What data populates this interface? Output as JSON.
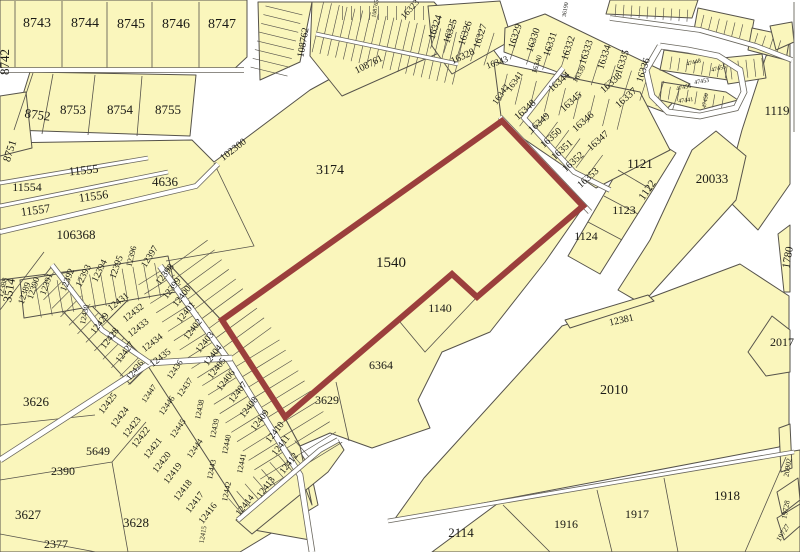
{
  "map": {
    "type": "cadastral-parcel-map",
    "highlighted_parcel": "1540",
    "colors": {
      "background": "#FFFFFF",
      "parcel_fill": "#FAF6BC",
      "parcel_border": "#56534B",
      "highlight_outline": "#9B3F3C",
      "road_casing": "#6A675E",
      "label": "#1A1A16"
    },
    "labels": [
      {
        "t": "8742",
        "x": 9,
        "y": 62,
        "r": -90,
        "s": 13
      },
      {
        "t": "8743",
        "x": 37,
        "y": 27,
        "r": 0,
        "s": 14
      },
      {
        "t": "8744",
        "x": 85,
        "y": 27,
        "r": 0,
        "s": 14
      },
      {
        "t": "8745",
        "x": 131,
        "y": 28,
        "r": 0,
        "s": 14
      },
      {
        "t": "8746",
        "x": 176,
        "y": 28,
        "r": 0,
        "s": 14
      },
      {
        "t": "8747",
        "x": 222,
        "y": 28,
        "r": 0,
        "s": 14
      },
      {
        "t": "8751",
        "x": 13,
        "y": 152,
        "r": -72,
        "s": 11
      },
      {
        "t": "8752",
        "x": 37,
        "y": 119,
        "r": 8,
        "s": 13
      },
      {
        "t": "8753",
        "x": 73,
        "y": 114,
        "r": 0,
        "s": 13
      },
      {
        "t": "8754",
        "x": 120,
        "y": 114,
        "r": 0,
        "s": 13
      },
      {
        "t": "8755",
        "x": 168,
        "y": 114,
        "r": 0,
        "s": 13
      },
      {
        "t": "11554",
        "x": 27,
        "y": 191,
        "r": 0,
        "s": 12
      },
      {
        "t": "11555",
        "x": 84,
        "y": 174,
        "r": -6,
        "s": 12
      },
      {
        "t": "11556",
        "x": 94,
        "y": 200,
        "r": -8,
        "s": 12
      },
      {
        "t": "11557",
        "x": 36,
        "y": 214,
        "r": -8,
        "s": 12
      },
      {
        "t": "4636",
        "x": 165,
        "y": 186,
        "r": 0,
        "s": 13
      },
      {
        "t": "106368",
        "x": 76,
        "y": 239,
        "r": 0,
        "s": 13
      },
      {
        "t": "3174",
        "x": 330,
        "y": 174,
        "r": 0,
        "s": 14
      },
      {
        "t": "1540",
        "x": 391,
        "y": 267,
        "r": 0,
        "s": 15
      },
      {
        "t": "1140",
        "x": 440,
        "y": 312,
        "r": 0,
        "s": 12
      },
      {
        "t": "6364",
        "x": 381,
        "y": 369,
        "r": 0,
        "s": 12
      },
      {
        "t": "3629",
        "x": 327,
        "y": 404,
        "r": 0,
        "s": 12
      },
      {
        "t": "102300",
        "x": 235,
        "y": 152,
        "r": -38,
        "s": 10
      },
      {
        "t": "108761",
        "x": 370,
        "y": 67,
        "r": -27,
        "s": 10
      },
      {
        "t": "108762",
        "x": 306,
        "y": 43,
        "r": -80,
        "s": 10
      },
      {
        "t": "108765",
        "x": 377,
        "y": 9,
        "r": -80,
        "s": 6
      },
      {
        "t": "36190",
        "x": 567,
        "y": 10,
        "r": -80,
        "s": 6
      },
      {
        "t": "3514",
        "x": 13,
        "y": 291,
        "r": -80,
        "s": 12
      },
      {
        "t": "3626",
        "x": 36,
        "y": 406,
        "r": 0,
        "s": 13
      },
      {
        "t": "2390",
        "x": 63,
        "y": 475,
        "r": 0,
        "s": 12
      },
      {
        "t": "5649",
        "x": 98,
        "y": 455,
        "r": 0,
        "s": 12
      },
      {
        "t": "3627",
        "x": 28,
        "y": 519,
        "r": 0,
        "s": 13
      },
      {
        "t": "3628",
        "x": 136,
        "y": 527,
        "r": 0,
        "s": 13
      },
      {
        "t": "2377",
        "x": 56,
        "y": 548,
        "r": 0,
        "s": 12
      },
      {
        "t": "12388",
        "x": 5,
        "y": 288,
        "r": -75,
        "s": 8
      },
      {
        "t": "12389",
        "x": 27,
        "y": 294,
        "r": -72,
        "s": 9
      },
      {
        "t": "12390",
        "x": 36,
        "y": 289,
        "r": -72,
        "s": 9
      },
      {
        "t": "12391",
        "x": 49,
        "y": 285,
        "r": -70,
        "s": 9
      },
      {
        "t": "12392",
        "x": 70,
        "y": 281,
        "r": -68,
        "s": 9.5
      },
      {
        "t": "12393",
        "x": 86,
        "y": 277,
        "r": -64,
        "s": 9.5
      },
      {
        "t": "12394",
        "x": 102,
        "y": 272,
        "r": -64,
        "s": 9.5
      },
      {
        "t": "12395",
        "x": 119,
        "y": 268,
        "r": -70,
        "s": 9.5
      },
      {
        "t": "12396",
        "x": 134,
        "y": 257,
        "r": -76,
        "s": 8.5
      },
      {
        "t": "12397",
        "x": 152,
        "y": 258,
        "r": -58,
        "s": 9.5
      },
      {
        "t": "12398",
        "x": 167,
        "y": 276,
        "r": -52,
        "s": 9.5
      },
      {
        "t": "12399",
        "x": 174,
        "y": 290,
        "r": -52,
        "s": 9.5
      },
      {
        "t": "12400",
        "x": 184,
        "y": 298,
        "r": -52,
        "s": 9.5
      },
      {
        "t": "12401",
        "x": 188,
        "y": 314,
        "r": -52,
        "s": 9.5
      },
      {
        "t": "12402",
        "x": 195,
        "y": 331,
        "r": -52,
        "s": 9.5
      },
      {
        "t": "12403",
        "x": 207,
        "y": 344,
        "r": -52,
        "s": 9.5
      },
      {
        "t": "12404",
        "x": 215,
        "y": 357,
        "r": -52,
        "s": 9.5
      },
      {
        "t": "12405",
        "x": 219,
        "y": 370,
        "r": -52,
        "s": 9.5
      },
      {
        "t": "12406",
        "x": 228,
        "y": 382,
        "r": -52,
        "s": 9.5
      },
      {
        "t": "12407",
        "x": 240,
        "y": 394,
        "r": -52,
        "s": 9.5
      },
      {
        "t": "12408",
        "x": 251,
        "y": 409,
        "r": -52,
        "s": 9.5
      },
      {
        "t": "12409",
        "x": 262,
        "y": 422,
        "r": -52,
        "s": 9.5
      },
      {
        "t": "12410",
        "x": 277,
        "y": 434,
        "r": -52,
        "s": 9.5
      },
      {
        "t": "12411",
        "x": 283,
        "y": 447,
        "r": -52,
        "s": 9.5
      },
      {
        "t": "12412",
        "x": 291,
        "y": 465,
        "r": -52,
        "s": 9.5
      },
      {
        "t": "12413",
        "x": 268,
        "y": 489,
        "r": -52,
        "s": 9.5
      },
      {
        "t": "12414",
        "x": 247,
        "y": 507,
        "r": -52,
        "s": 9.5
      },
      {
        "t": "12415",
        "x": 205,
        "y": 535,
        "r": -80,
        "s": 7
      },
      {
        "t": "12416",
        "x": 210,
        "y": 515,
        "r": -52,
        "s": 9.5
      },
      {
        "t": "12417",
        "x": 197,
        "y": 504,
        "r": -52,
        "s": 9.5
      },
      {
        "t": "12418",
        "x": 185,
        "y": 492,
        "r": -52,
        "s": 9.5
      },
      {
        "t": "12419",
        "x": 175,
        "y": 475,
        "r": -52,
        "s": 9.5
      },
      {
        "t": "12420",
        "x": 164,
        "y": 464,
        "r": -52,
        "s": 9.5
      },
      {
        "t": "12421",
        "x": 155,
        "y": 450,
        "r": -52,
        "s": 9.5
      },
      {
        "t": "12422",
        "x": 143,
        "y": 439,
        "r": -52,
        "s": 9.5
      },
      {
        "t": "12423",
        "x": 134,
        "y": 429,
        "r": -52,
        "s": 9.5
      },
      {
        "t": "12424",
        "x": 122,
        "y": 419,
        "r": -52,
        "s": 9.5
      },
      {
        "t": "12425",
        "x": 110,
        "y": 405,
        "r": -52,
        "s": 9.5
      },
      {
        "t": "12426",
        "x": 137,
        "y": 372,
        "r": -52,
        "s": 9
      },
      {
        "t": "12427",
        "x": 127,
        "y": 354,
        "r": -52,
        "s": 9.5
      },
      {
        "t": "12428",
        "x": 112,
        "y": 340,
        "r": -52,
        "s": 9.5
      },
      {
        "t": "12429",
        "x": 102,
        "y": 325,
        "r": -52,
        "s": 9.5
      },
      {
        "t": "12430",
        "x": 87,
        "y": 315,
        "r": -78,
        "s": 8
      },
      {
        "t": "12431",
        "x": 120,
        "y": 304,
        "r": -38,
        "s": 9.5
      },
      {
        "t": "12432",
        "x": 135,
        "y": 315,
        "r": -38,
        "s": 9.5
      },
      {
        "t": "12433",
        "x": 140,
        "y": 330,
        "r": -38,
        "s": 9.5
      },
      {
        "t": "12434",
        "x": 154,
        "y": 345,
        "r": -38,
        "s": 9.5
      },
      {
        "t": "12435",
        "x": 162,
        "y": 360,
        "r": -38,
        "s": 9.5
      },
      {
        "t": "12436",
        "x": 177,
        "y": 371,
        "r": -55,
        "s": 8.5
      },
      {
        "t": "12437",
        "x": 187,
        "y": 389,
        "r": -55,
        "s": 8.5
      },
      {
        "t": "12438",
        "x": 202,
        "y": 410,
        "r": -78,
        "s": 8
      },
      {
        "t": "12439",
        "x": 217,
        "y": 429,
        "r": -78,
        "s": 8
      },
      {
        "t": "12440",
        "x": 229,
        "y": 445,
        "r": -78,
        "s": 8
      },
      {
        "t": "12441",
        "x": 244,
        "y": 464,
        "r": -78,
        "s": 8
      },
      {
        "t": "12442",
        "x": 229,
        "y": 492,
        "r": -78,
        "s": 8
      },
      {
        "t": "12443",
        "x": 214,
        "y": 470,
        "r": -78,
        "s": 8
      },
      {
        "t": "12444",
        "x": 197,
        "y": 450,
        "r": -55,
        "s": 8.5
      },
      {
        "t": "12445",
        "x": 180,
        "y": 430,
        "r": -55,
        "s": 8.5
      },
      {
        "t": "12446",
        "x": 169,
        "y": 407,
        "r": -55,
        "s": 8.5
      },
      {
        "t": "12447",
        "x": 151,
        "y": 395,
        "r": -55,
        "s": 8
      },
      {
        "t": "16323",
        "x": 412,
        "y": 11,
        "r": -48,
        "s": 9
      },
      {
        "t": "16324",
        "x": 438,
        "y": 28,
        "r": -72,
        "s": 10
      },
      {
        "t": "16325",
        "x": 453,
        "y": 32,
        "r": -72,
        "s": 10
      },
      {
        "t": "16326",
        "x": 468,
        "y": 34,
        "r": -72,
        "s": 10
      },
      {
        "t": "16327",
        "x": 483,
        "y": 37,
        "r": -72,
        "s": 10
      },
      {
        "t": "16328",
        "x": 464,
        "y": 59,
        "r": -25,
        "s": 10
      },
      {
        "t": "16329",
        "x": 518,
        "y": 37,
        "r": -72,
        "s": 10
      },
      {
        "t": "16330",
        "x": 536,
        "y": 41,
        "r": -72,
        "s": 10
      },
      {
        "t": "16331",
        "x": 553,
        "y": 45,
        "r": -72,
        "s": 10
      },
      {
        "t": "16332",
        "x": 571,
        "y": 49,
        "r": -72,
        "s": 10
      },
      {
        "t": "16333",
        "x": 589,
        "y": 53,
        "r": -72,
        "s": 10
      },
      {
        "t": "16334",
        "x": 607,
        "y": 58,
        "r": -72,
        "s": 10
      },
      {
        "t": "16335",
        "x": 625,
        "y": 63,
        "r": -72,
        "s": 10
      },
      {
        "t": "16336",
        "x": 646,
        "y": 71,
        "r": -72,
        "s": 10
      },
      {
        "t": "16343",
        "x": 498,
        "y": 65,
        "r": -20,
        "s": 9
      },
      {
        "t": "16340",
        "x": 539,
        "y": 65,
        "r": -72,
        "s": 7.5
      },
      {
        "t": "16339",
        "x": 581,
        "y": 75,
        "r": -60,
        "s": 7.5
      },
      {
        "t": "16338",
        "x": 613,
        "y": 85,
        "r": -42,
        "s": 10
      },
      {
        "t": "16337",
        "x": 628,
        "y": 100,
        "r": -42,
        "s": 10
      },
      {
        "t": "16341",
        "x": 517,
        "y": 83,
        "r": -55,
        "s": 9
      },
      {
        "t": "16342",
        "x": 503,
        "y": 96,
        "r": -55,
        "s": 9
      },
      {
        "t": "16344",
        "x": 561,
        "y": 84,
        "r": -42,
        "s": 10
      },
      {
        "t": "16345",
        "x": 573,
        "y": 104,
        "r": -42,
        "s": 10
      },
      {
        "t": "16346",
        "x": 585,
        "y": 124,
        "r": -42,
        "s": 10
      },
      {
        "t": "16347",
        "x": 600,
        "y": 143,
        "r": -42,
        "s": 10
      },
      {
        "t": "16348",
        "x": 527,
        "y": 112,
        "r": -42,
        "s": 10
      },
      {
        "t": "16349",
        "x": 541,
        "y": 125,
        "r": -42,
        "s": 10
      },
      {
        "t": "16350",
        "x": 553,
        "y": 140,
        "r": -42,
        "s": 10
      },
      {
        "t": "16351",
        "x": 564,
        "y": 152,
        "r": -42,
        "s": 10
      },
      {
        "t": "16352",
        "x": 575,
        "y": 164,
        "r": -42,
        "s": 10
      },
      {
        "t": "16353",
        "x": 590,
        "y": 180,
        "r": -42,
        "s": 10
      },
      {
        "t": "47448",
        "x": 694,
        "y": 64,
        "r": -14,
        "s": 6
      },
      {
        "t": "47455",
        "x": 719,
        "y": 70,
        "r": -14,
        "s": 6
      },
      {
        "t": "47453",
        "x": 702,
        "y": 83,
        "r": -10,
        "s": 6
      },
      {
        "t": "47456",
        "x": 684,
        "y": 89,
        "r": -12,
        "s": 6
      },
      {
        "t": "47441",
        "x": 686,
        "y": 102,
        "r": -8,
        "s": 6
      },
      {
        "t": "47450",
        "x": 707,
        "y": 101,
        "r": -80,
        "s": 6
      },
      {
        "t": "1121",
        "x": 640,
        "y": 168,
        "r": 0,
        "s": 13
      },
      {
        "t": "1122",
        "x": 650,
        "y": 192,
        "r": -55,
        "s": 11
      },
      {
        "t": "1123",
        "x": 624,
        "y": 214,
        "r": 0,
        "s": 12
      },
      {
        "t": "1124",
        "x": 586,
        "y": 240,
        "r": 0,
        "s": 12
      },
      {
        "t": "1119",
        "x": 777,
        "y": 115,
        "r": 0,
        "s": 13
      },
      {
        "t": "20033",
        "x": 712,
        "y": 183,
        "r": 0,
        "s": 13
      },
      {
        "t": "1780",
        "x": 791,
        "y": 258,
        "r": -80,
        "s": 11
      },
      {
        "t": "12381",
        "x": 622,
        "y": 323,
        "r": -13,
        "s": 10
      },
      {
        "t": "2017",
        "x": 782,
        "y": 346,
        "r": 0,
        "s": 12
      },
      {
        "t": "2010",
        "x": 614,
        "y": 394,
        "r": 0,
        "s": 14
      },
      {
        "t": "2114",
        "x": 461,
        "y": 537,
        "r": 0,
        "s": 13
      },
      {
        "t": "1916",
        "x": 566,
        "y": 528,
        "r": 0,
        "s": 12
      },
      {
        "t": "1917",
        "x": 637,
        "y": 518,
        "r": 0,
        "s": 12
      },
      {
        "t": "1918",
        "x": 727,
        "y": 500,
        "r": 0,
        "s": 13
      },
      {
        "t": "20902",
        "x": 790,
        "y": 468,
        "r": -80,
        "s": 7.5
      },
      {
        "t": "19728",
        "x": 788,
        "y": 510,
        "r": -80,
        "s": 7.5
      },
      {
        "t": "19727",
        "x": 785,
        "y": 534,
        "r": -58,
        "s": 7.5
      }
    ]
  }
}
